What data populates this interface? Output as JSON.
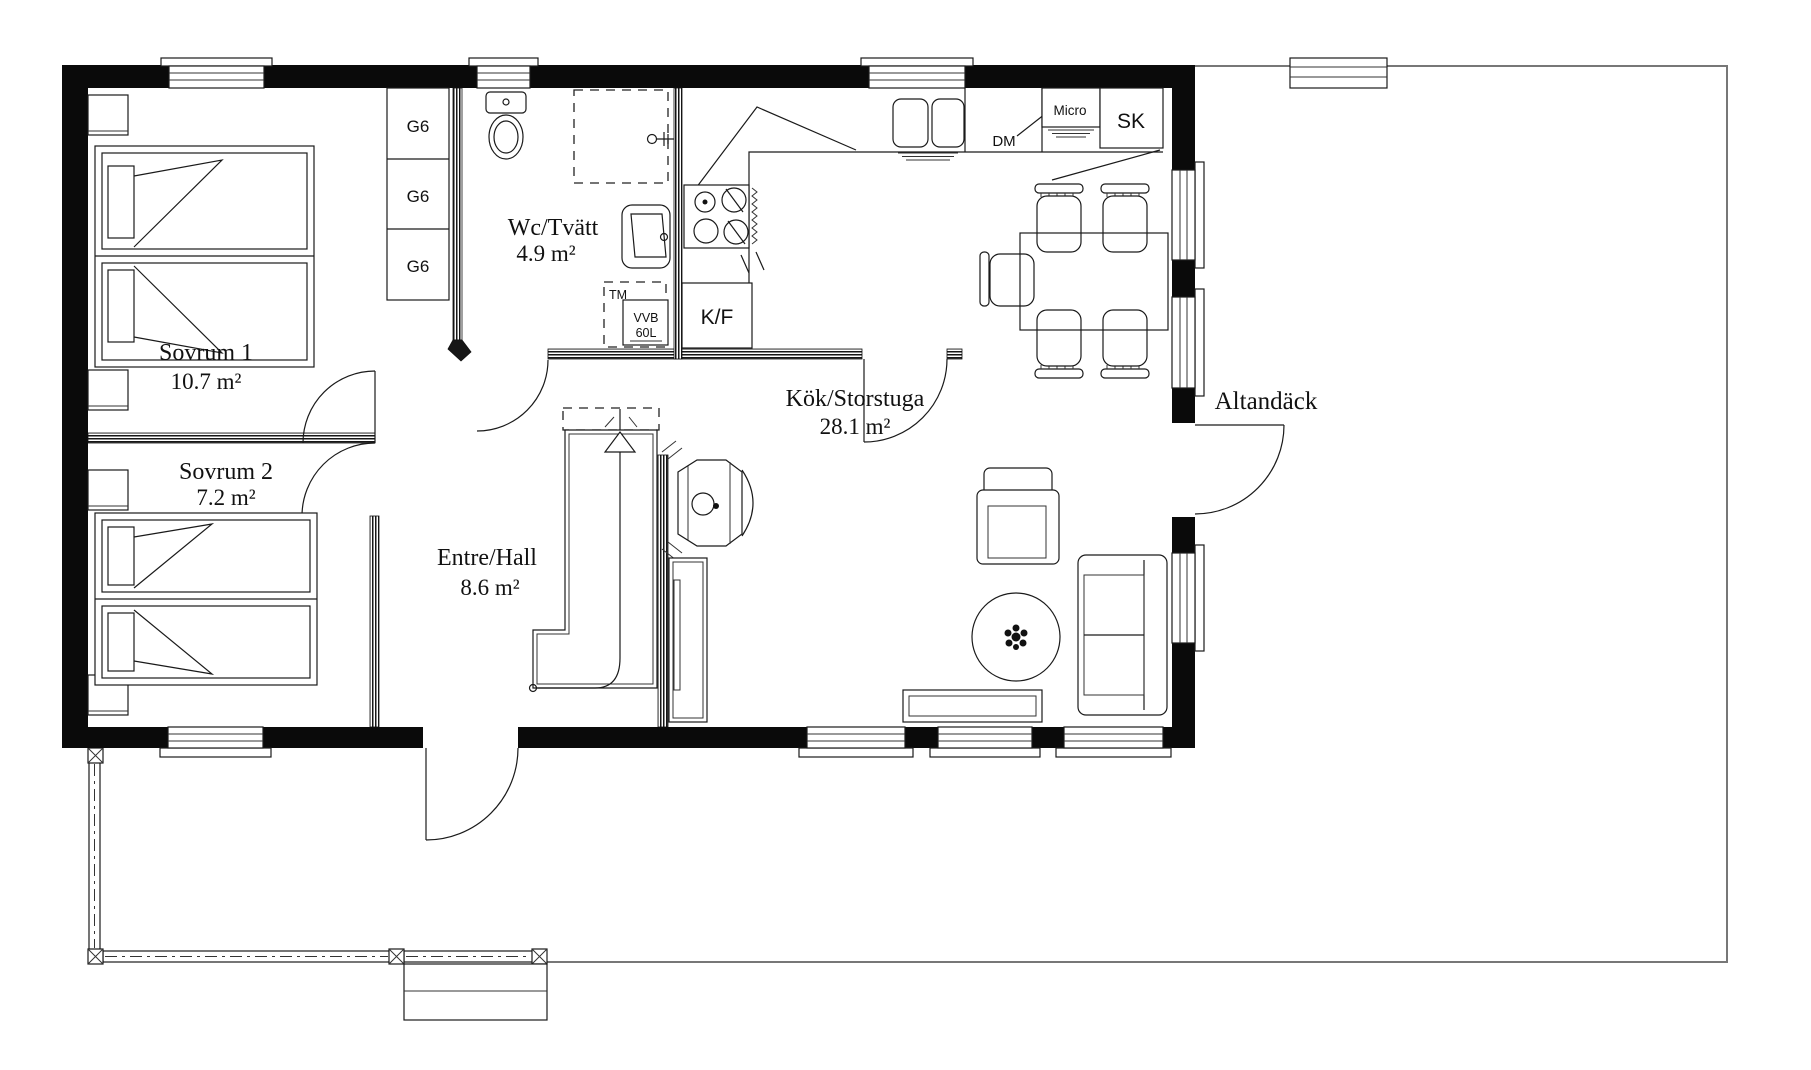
{
  "plan_title": "Floor plan",
  "rooms": [
    {
      "id": "sovrum1",
      "name": "Sovrum 1",
      "area": "10.7 m²"
    },
    {
      "id": "sovrum2",
      "name": "Sovrum 2",
      "area": "7.2 m²"
    },
    {
      "id": "wc-tvatt",
      "name": "Wc/Tvätt",
      "area": "4.9 m²"
    },
    {
      "id": "entre-hall",
      "name": "Entre/Hall",
      "area": "8.6 m²"
    },
    {
      "id": "kok-storstuga",
      "name": "Kök/Storstuga",
      "area": "28.1 m²"
    }
  ],
  "outdoor": {
    "deck_label": "Altandäck"
  },
  "fixtures": {
    "wardrobes": [
      "G6",
      "G6",
      "G6"
    ],
    "washing_machine": "TM",
    "water_heater_line1": "VVB",
    "water_heater_line2": "60L",
    "fridge_freezer": "K/F",
    "dishwasher": "DM",
    "microwave": "Micro",
    "tall_cabinet": "SK"
  },
  "colors": {
    "exterior_wall": "#0a0a0a",
    "drawing_line": "#1a1a1a",
    "deck_line": "#777777"
  }
}
